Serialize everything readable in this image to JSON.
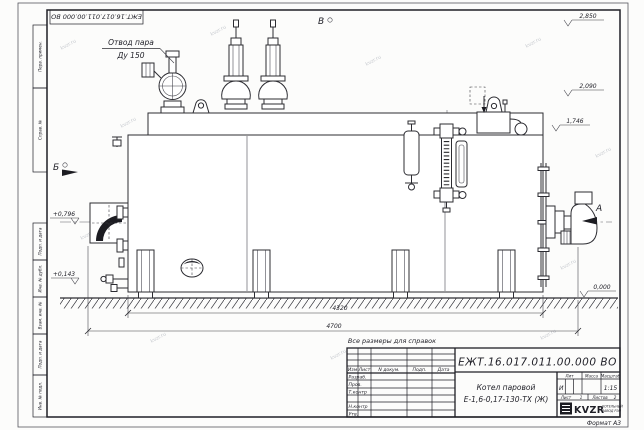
{
  "watermark": {
    "text": "kvzr.ru"
  },
  "frame": {
    "doc_number_top": "ЕЖТ.16.017.011.00.000  ВО",
    "format_label": "Формат А3",
    "side_labels": [
      "Перв. примен.",
      "Справ. №",
      "Подп. и дата",
      "Инв. № дубл.",
      "Взам. инв. №",
      "Подп. и дата",
      "Инв. № подл."
    ]
  },
  "annotations": {
    "steam_outlet_line1": "Отвод пара",
    "steam_outlet_line2": "Ду 150",
    "view_v": "В",
    "view_b": "Б",
    "view_a": "А",
    "elev_top": "2,850",
    "elev_mid": "2,090",
    "elev_drum": "1,746",
    "elev_zero": "0,000",
    "elev_front_hi": "+0,796",
    "elev_front_lo": "+0,143",
    "dim_body": "4320",
    "dim_total": "4700",
    "note_reference": "Все размеры для справок"
  },
  "title_block": {
    "doc_number": "ЕЖТ.16.017.011.00.000  ВО",
    "product_name_line1": "Котел паровой",
    "product_name_line2": "Е-1,6-0,17-130-ТХ (Ж)",
    "header_izm": "Изм",
    "header_list": "Лист",
    "header_ndocum": "N докум.",
    "header_podp": "Подп.",
    "header_data": "Дата",
    "rows": [
      "Разраб.",
      "Пров.",
      "Т.контр",
      "",
      "Н.контр",
      "Утв."
    ],
    "lit_label": "Лит",
    "massa_label": "Масса",
    "masshtab_label": "Масштаб",
    "lit_value": "И",
    "scale_value": "1:15",
    "sheet_label": "Лист",
    "sheet_value": "1",
    "sheets_label": "Листов",
    "sheets_value": "2",
    "logo_text": "KVZR",
    "logo_caption_line1": "КОТЕЛЬНЫЙ",
    "logo_caption_line2": "ЗАВОД РЭП"
  }
}
